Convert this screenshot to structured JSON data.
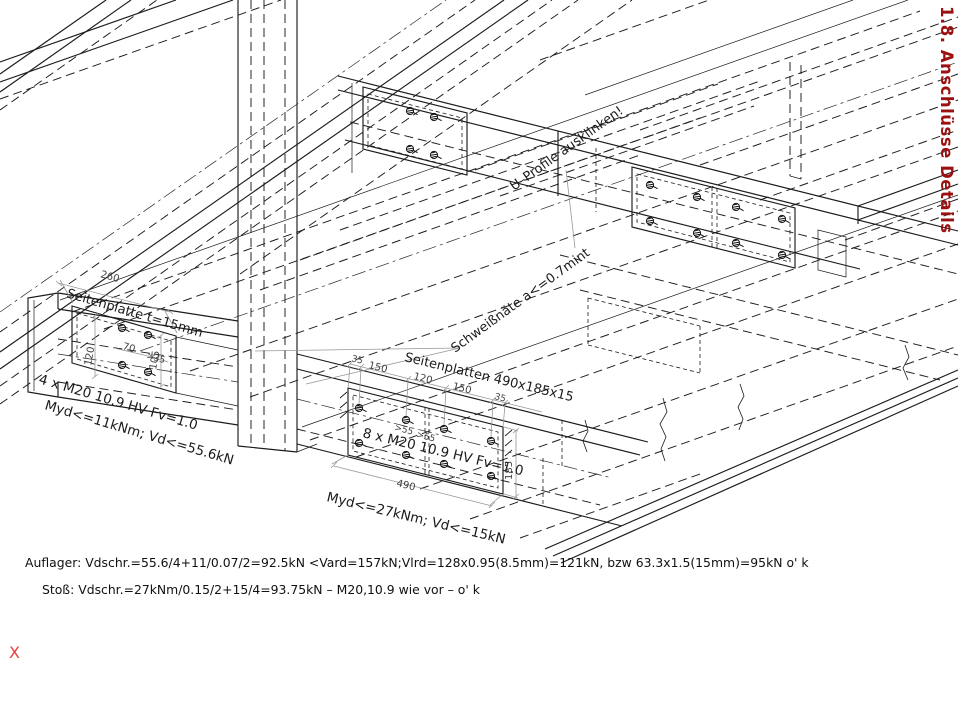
{
  "sheet": {
    "title": "1.8. Anschlüsse Details",
    "marker": "X"
  },
  "calc": {
    "auflager": "Auflager: Vdschr.=55.6/4+11/0.07/2=92.5kN <Vard=157kN;Vlrd=128x0.95(8.5mm)=121kN, bzw 63.3x1.5(15mm)=95kN o' k",
    "stoss": "Stoß: Vdschr.=27kNm/0.15/2+15/4=93.75kN  – M20,10.9 wie vor – o' k"
  },
  "support_detail": {
    "plate": "Seitenplatte t=15mm",
    "bolts": "4 x M20 10.9 HV Fv=1.0",
    "capacity": "Myd<=11kNm; Vd<=55.6kN",
    "dim_width": "260",
    "dim_row": "120",
    "dim_spacing": "70",
    "dim_edge": ">35",
    "dim_height": "105"
  },
  "splice_detail": {
    "plate": "Seitenplatten 490x185x15",
    "bolts": "8 x M20 10.9 HV Fv=1.0",
    "capacity": "Myd<=27kNm; Vd<=15kN",
    "weld": "Schweißnäte a<=0.7mint",
    "notch": "U–Profile ausklinken!",
    "dim_edge_l": "35",
    "dim_1": "150",
    "dim_2": "120",
    "dim_3": "150",
    "dim_edge_r": "35",
    "dim_e1": ">55",
    "dim_e2": ">55",
    "dim_height": "185",
    "dim_length": "490"
  }
}
